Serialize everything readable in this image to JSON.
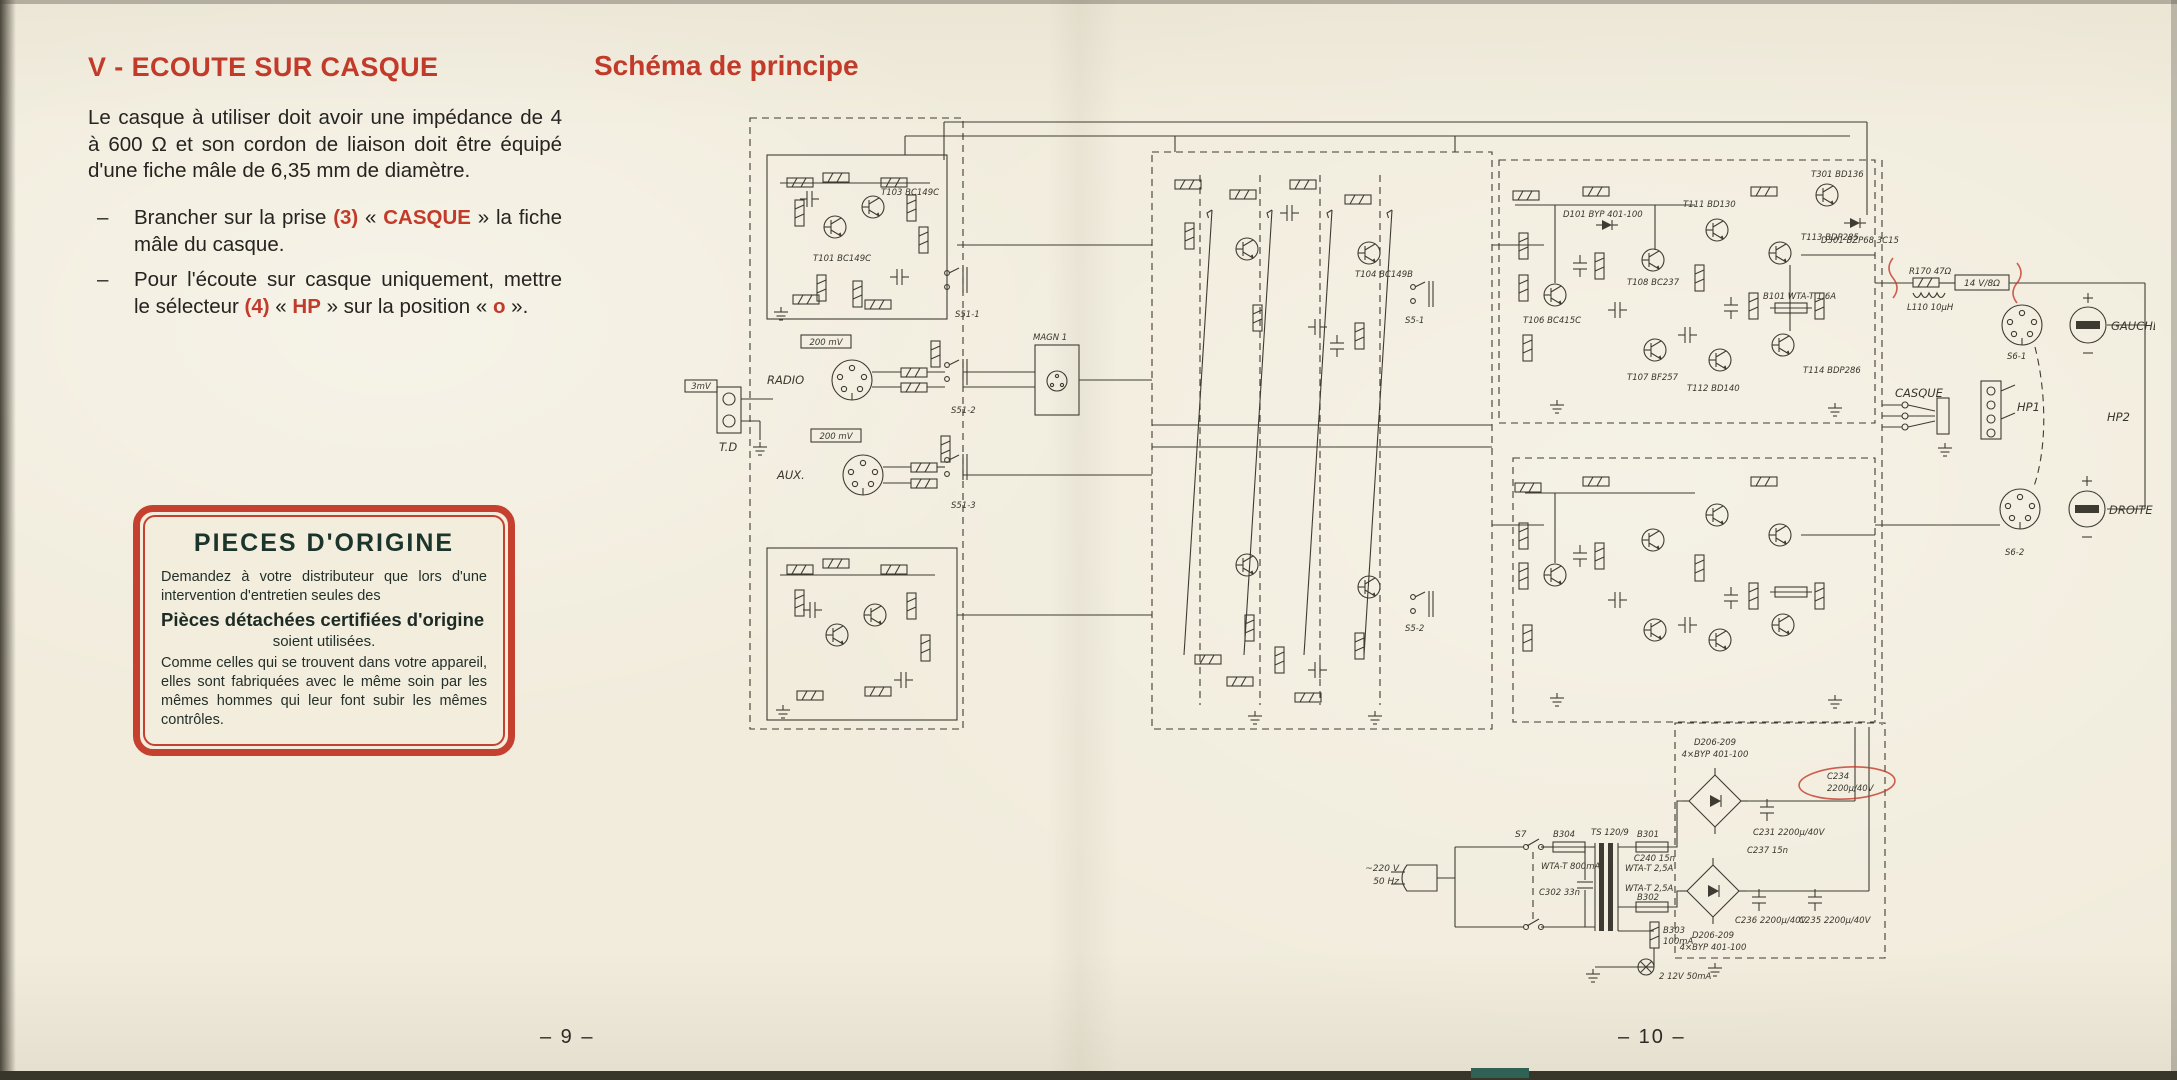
{
  "left_page": {
    "heading": "V - ECOUTE SUR CASQUE",
    "intro": "Le casque à utiliser doit avoir une impédance de 4 à 600 Ω et son cordon de liaison doit être équipé d'une fiche mâle de 6,35 mm de diamètre.",
    "bullet1": {
      "dash": "–",
      "pre": "Brancher sur la prise ",
      "ref": "(3)",
      "open": " « ",
      "accent": "CASQUE",
      "close": " » ",
      "post": "la fiche mâle du casque."
    },
    "bullet2": {
      "dash": "–",
      "pre": "Pour l'écoute sur casque uniquement, mettre le sélecteur ",
      "ref": "(4)",
      "open": " « ",
      "accent": "HP",
      "close": " » ",
      "mid": "sur la position « ",
      "accent2": "o",
      "end": " »."
    },
    "origin_box": {
      "title": "PIECES D'ORIGINE",
      "p1": "Demandez à votre distributeur que lors d'une intervention d'entretien seules des",
      "highlight": "Pièces détachées certifiées d'origine",
      "p2": "soient utilisées.",
      "p3": "Comme celles qui se trouvent dans votre appareil, elles sont fabriquées avec le même soin par les mêmes hommes qui leur font subir les mêmes contrôles."
    },
    "page_number": "– 9 –"
  },
  "right_page": {
    "heading": "Schéma de principe",
    "page_number": "– 10 –"
  },
  "schematic": {
    "labels": {
      "td": "T.D",
      "td_level": "3mV",
      "radio": "RADIO",
      "radio_level": "200 mV",
      "aux": "AUX.",
      "aux_level": "200 mV",
      "magn": "MAGN 1",
      "s51_1": "S51-1",
      "s51_2": "S51-2",
      "s51_3": "S51-3",
      "s5_1": "S5-1",
      "s5_2": "S5-2",
      "t101": "T101 BC149C",
      "t103": "T103 BC149C",
      "t104": "T104 BC149B",
      "t106": "T106 BC415C",
      "t107": "T107 BF257",
      "t108": "T108 BC237",
      "d101": "D101 BYP 401-100",
      "b101": "B101 WTA-T 1,6A",
      "t111": "T111 BD130",
      "t112": "T112 BD140",
      "t113": "T113 BDP285",
      "t114": "T114 BDP286",
      "t301": "T301 BD136",
      "d301": "D301 BZP68 3C15",
      "r170": "R170 47Ω",
      "l110": "L110 10µH",
      "out_level": "14 V/8Ω",
      "casque": "CASQUE",
      "gauche": "GAUCHE",
      "droite": "DROITE",
      "hp1": "HP1",
      "hp2": "HP2",
      "s6_1": "S6-1",
      "s6_2": "S6-2",
      "s7": "S7",
      "mains_v": "~220 V",
      "mains_hz": "50 Hz",
      "b304": "B304",
      "b304_val": "WTA-T 800mA",
      "c302": "C302 33n",
      "transformer": "TS 120/9",
      "b301": "B301",
      "b301_val": "WTA-T 2,5A",
      "b302": "B302",
      "b302_val": "WTA-T 2,5A",
      "b303": "B303",
      "b303_val": "100mA",
      "lamp": "2  12V 50mA",
      "d206_a": "D206-209",
      "d206_b": "4×BYP 401-100",
      "c240": "C240 15n",
      "c237": "C237 15n",
      "c231": "C231 2200µ/40V",
      "c236": "C236 2200µ/40V",
      "c235": "C235 2200µ/40V",
      "c234": "C234",
      "c234_val": "2200µ/40V"
    }
  },
  "colors": {
    "accent_red": "#c23a2a",
    "paper": "#f1ecdc",
    "ink": "#3e3c32",
    "origin_title": "#1c352c"
  }
}
